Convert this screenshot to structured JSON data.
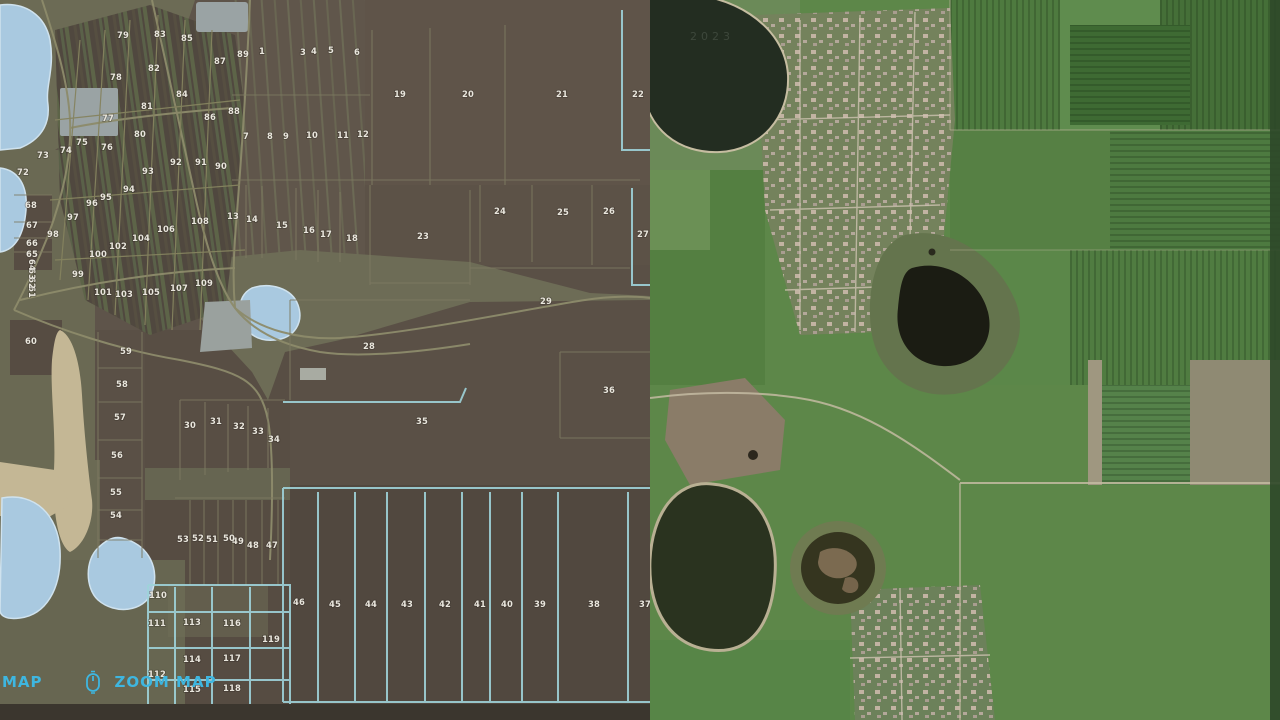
{
  "hud": {
    "corner_label": "MAP",
    "zoom_label": "ZOOM MAP",
    "accent": "#3eb6e0"
  },
  "satellite": {
    "watermark": "2023"
  },
  "map": {
    "field_label_color": "#e9e6dd",
    "icon_fill_top": "#5ec8f2",
    "icon_fill_bottom": "#1e8ac2",
    "fields": [
      {
        "n": "1",
        "x": 262,
        "y": 54
      },
      {
        "n": "3",
        "x": 303,
        "y": 55
      },
      {
        "n": "4",
        "x": 314,
        "y": 54
      },
      {
        "n": "5",
        "x": 331,
        "y": 53
      },
      {
        "n": "6",
        "x": 357,
        "y": 55
      },
      {
        "n": "7",
        "x": 246,
        "y": 139
      },
      {
        "n": "8",
        "x": 270,
        "y": 139
      },
      {
        "n": "9",
        "x": 286,
        "y": 139
      },
      {
        "n": "10",
        "x": 312,
        "y": 138
      },
      {
        "n": "11",
        "x": 343,
        "y": 138
      },
      {
        "n": "12",
        "x": 363,
        "y": 137
      },
      {
        "n": "13",
        "x": 233,
        "y": 219
      },
      {
        "n": "14",
        "x": 252,
        "y": 222
      },
      {
        "n": "15",
        "x": 282,
        "y": 228
      },
      {
        "n": "16",
        "x": 309,
        "y": 233
      },
      {
        "n": "17",
        "x": 326,
        "y": 237
      },
      {
        "n": "18",
        "x": 352,
        "y": 241
      },
      {
        "n": "19",
        "x": 400,
        "y": 97
      },
      {
        "n": "20",
        "x": 468,
        "y": 97
      },
      {
        "n": "21",
        "x": 562,
        "y": 97
      },
      {
        "n": "22",
        "x": 638,
        "y": 97
      },
      {
        "n": "23",
        "x": 423,
        "y": 239
      },
      {
        "n": "24",
        "x": 500,
        "y": 214
      },
      {
        "n": "25",
        "x": 563,
        "y": 215
      },
      {
        "n": "26",
        "x": 609,
        "y": 214
      },
      {
        "n": "27",
        "x": 643,
        "y": 237
      },
      {
        "n": "28",
        "x": 369,
        "y": 349
      },
      {
        "n": "29",
        "x": 546,
        "y": 304
      },
      {
        "n": "30",
        "x": 190,
        "y": 428
      },
      {
        "n": "31",
        "x": 216,
        "y": 424
      },
      {
        "n": "32",
        "x": 239,
        "y": 429
      },
      {
        "n": "33",
        "x": 258,
        "y": 434
      },
      {
        "n": "34",
        "x": 274,
        "y": 442
      },
      {
        "n": "35",
        "x": 422,
        "y": 424
      },
      {
        "n": "36",
        "x": 609,
        "y": 393
      },
      {
        "n": "37",
        "x": 645,
        "y": 607
      },
      {
        "n": "38",
        "x": 594,
        "y": 607
      },
      {
        "n": "39",
        "x": 540,
        "y": 607
      },
      {
        "n": "40",
        "x": 507,
        "y": 607
      },
      {
        "n": "41",
        "x": 480,
        "y": 607
      },
      {
        "n": "42",
        "x": 445,
        "y": 607
      },
      {
        "n": "43",
        "x": 407,
        "y": 607
      },
      {
        "n": "44",
        "x": 371,
        "y": 607
      },
      {
        "n": "45",
        "x": 335,
        "y": 607
      },
      {
        "n": "46",
        "x": 299,
        "y": 605
      },
      {
        "n": "47",
        "x": 272,
        "y": 548
      },
      {
        "n": "48",
        "x": 253,
        "y": 548
      },
      {
        "n": "49",
        "x": 238,
        "y": 544
      },
      {
        "n": "50",
        "x": 229,
        "y": 541
      },
      {
        "n": "51",
        "x": 212,
        "y": 542
      },
      {
        "n": "52",
        "x": 198,
        "y": 541
      },
      {
        "n": "53",
        "x": 183,
        "y": 542
      },
      {
        "n": "54",
        "x": 116,
        "y": 518
      },
      {
        "n": "55",
        "x": 116,
        "y": 495
      },
      {
        "n": "56",
        "x": 117,
        "y": 458
      },
      {
        "n": "57",
        "x": 120,
        "y": 420
      },
      {
        "n": "58",
        "x": 122,
        "y": 387
      },
      {
        "n": "59",
        "x": 126,
        "y": 354
      },
      {
        "n": "60",
        "x": 31,
        "y": 344
      },
      {
        "n": "61",
        "x": 29,
        "y": 292,
        "r": 90
      },
      {
        "n": "62",
        "x": 29,
        "y": 283,
        "r": 90
      },
      {
        "n": "63",
        "x": 29,
        "y": 274,
        "r": 90
      },
      {
        "n": "64",
        "x": 29,
        "y": 265,
        "r": 90
      },
      {
        "n": "65",
        "x": 32,
        "y": 257
      },
      {
        "n": "66",
        "x": 32,
        "y": 246
      },
      {
        "n": "67",
        "x": 32,
        "y": 228
      },
      {
        "n": "68",
        "x": 31,
        "y": 208
      },
      {
        "n": "72",
        "x": 23,
        "y": 175
      },
      {
        "n": "73",
        "x": 43,
        "y": 158
      },
      {
        "n": "74",
        "x": 66,
        "y": 153
      },
      {
        "n": "75",
        "x": 82,
        "y": 145
      },
      {
        "n": "76",
        "x": 107,
        "y": 150
      },
      {
        "n": "77",
        "x": 108,
        "y": 121
      },
      {
        "n": "78",
        "x": 116,
        "y": 80
      },
      {
        "n": "79",
        "x": 123,
        "y": 38
      },
      {
        "n": "80",
        "x": 140,
        "y": 137
      },
      {
        "n": "81",
        "x": 147,
        "y": 109
      },
      {
        "n": "82",
        "x": 154,
        "y": 71
      },
      {
        "n": "83",
        "x": 160,
        "y": 37
      },
      {
        "n": "84",
        "x": 182,
        "y": 97
      },
      {
        "n": "85",
        "x": 187,
        "y": 41
      },
      {
        "n": "86",
        "x": 210,
        "y": 120
      },
      {
        "n": "87",
        "x": 220,
        "y": 64
      },
      {
        "n": "88",
        "x": 234,
        "y": 114
      },
      {
        "n": "89",
        "x": 243,
        "y": 57
      },
      {
        "n": "90",
        "x": 221,
        "y": 169
      },
      {
        "n": "91",
        "x": 201,
        "y": 165
      },
      {
        "n": "92",
        "x": 176,
        "y": 165
      },
      {
        "n": "93",
        "x": 148,
        "y": 174
      },
      {
        "n": "94",
        "x": 129,
        "y": 192
      },
      {
        "n": "95",
        "x": 106,
        "y": 200
      },
      {
        "n": "96",
        "x": 92,
        "y": 206
      },
      {
        "n": "97",
        "x": 73,
        "y": 220
      },
      {
        "n": "98",
        "x": 53,
        "y": 237
      },
      {
        "n": "99",
        "x": 78,
        "y": 277
      },
      {
        "n": "100",
        "x": 98,
        "y": 257
      },
      {
        "n": "101",
        "x": 103,
        "y": 295
      },
      {
        "n": "102",
        "x": 118,
        "y": 249
      },
      {
        "n": "103",
        "x": 124,
        "y": 297
      },
      {
        "n": "104",
        "x": 141,
        "y": 241
      },
      {
        "n": "105",
        "x": 151,
        "y": 295
      },
      {
        "n": "106",
        "x": 166,
        "y": 232
      },
      {
        "n": "107",
        "x": 179,
        "y": 291
      },
      {
        "n": "108",
        "x": 200,
        "y": 224
      },
      {
        "n": "109",
        "x": 204,
        "y": 286
      },
      {
        "n": "110",
        "x": 158,
        "y": 598
      },
      {
        "n": "111",
        "x": 157,
        "y": 626
      },
      {
        "n": "112",
        "x": 157,
        "y": 677
      },
      {
        "n": "113",
        "x": 192,
        "y": 625
      },
      {
        "n": "114",
        "x": 192,
        "y": 662
      },
      {
        "n": "115",
        "x": 192,
        "y": 692
      },
      {
        "n": "116",
        "x": 232,
        "y": 626
      },
      {
        "n": "117",
        "x": 232,
        "y": 661
      },
      {
        "n": "118",
        "x": 232,
        "y": 691
      },
      {
        "n": "119",
        "x": 271,
        "y": 642
      }
    ],
    "icons": [
      {
        "name": "water-tower-icon",
        "x": 200,
        "y": 12,
        "s": 30,
        "g": "fountain"
      },
      {
        "name": "productions-icon",
        "x": 138,
        "y": 30,
        "s": 26,
        "g": "case"
      },
      {
        "name": "workshop-icon",
        "x": 95,
        "y": 55,
        "s": 26,
        "g": "tools"
      },
      {
        "name": "sell-point-icon",
        "x": 290,
        "y": 48,
        "s": 36,
        "g": "selldown"
      },
      {
        "name": "monument-icon",
        "x": 160,
        "y": 130,
        "s": 26,
        "g": "fountain"
      },
      {
        "name": "mill-icon",
        "x": 150,
        "y": 196,
        "s": 28,
        "g": "factory"
      },
      {
        "name": "shop-icon",
        "x": 85,
        "y": 245,
        "s": 26,
        "g": "case"
      },
      {
        "name": "fuel-station-icon",
        "x": 228,
        "y": 291,
        "s": 24,
        "g": "bottle"
      },
      {
        "name": "store-icon",
        "x": 216,
        "y": 308,
        "s": 24,
        "g": "case"
      },
      {
        "name": "vehicle-shop-icon",
        "x": 185,
        "y": 596,
        "s": 24,
        "g": "tractor"
      },
      {
        "name": "trailer-dealer-icon",
        "x": 198,
        "y": 601,
        "s": 24,
        "g": "trailer"
      },
      {
        "name": "silo-icon",
        "x": 217,
        "y": 602,
        "s": 26,
        "g": "silo"
      },
      {
        "name": "fuel-icon",
        "x": 235,
        "y": 592,
        "s": 26,
        "g": "bottle"
      },
      {
        "name": "harvester-icon",
        "x": 246,
        "y": 604,
        "s": 26,
        "g": "harvester"
      },
      {
        "name": "photo-icon",
        "x": 207,
        "y": 632,
        "s": 24,
        "g": "camera"
      },
      {
        "name": "fountain-icon",
        "x": 271,
        "y": 678,
        "s": 26,
        "g": "fountain"
      },
      {
        "name": "animal-dealer-icon",
        "x": 265,
        "y": 702,
        "s": 26,
        "g": "animal"
      }
    ]
  }
}
